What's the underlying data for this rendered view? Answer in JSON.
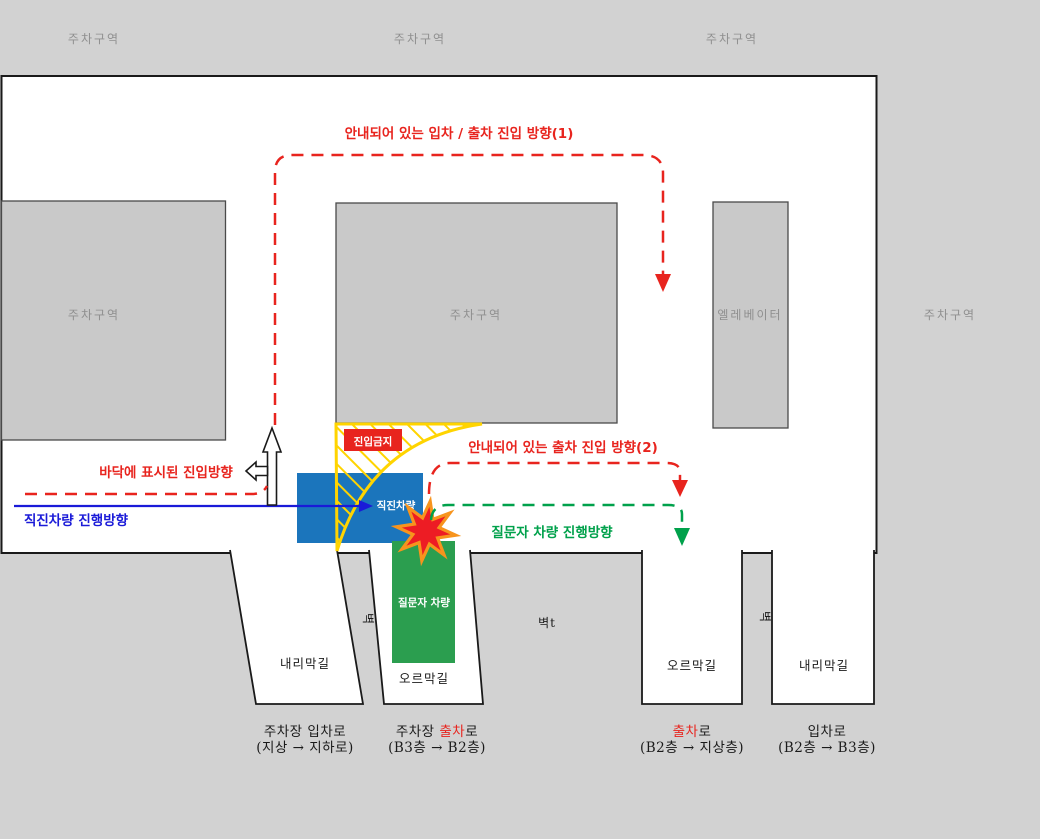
{
  "top_band": {
    "left": "주차구역",
    "middle": "주차구역",
    "right": "주차구역"
  },
  "zones": {
    "left_parking": "주차구역",
    "middle_parking": "주차구역",
    "elevator": "엘레베이터",
    "right_parking": "주차구역"
  },
  "labels": {
    "route1": "안내되어 있는 입차 / 출차 진입 방향(1)",
    "route2": "안내되어 있는 출차 진입 방향(2)",
    "questioner_route": "질문자 차량 진행방향",
    "floor_marked": "바닥에 표시된 진입방향",
    "straight_route": "직진차량 진행방향",
    "no_entry": "진입금지"
  },
  "vehicles": {
    "straight": "직진차량",
    "questioner": "질문자 차량"
  },
  "walls": {
    "left": "벽",
    "middle": "벽t",
    "right": "벽"
  },
  "ramps": {
    "bottom_left": "내리막길",
    "bottom_middle": "오르막길",
    "right_up": "오르막길",
    "right_down": "내리막길"
  },
  "exits": {
    "entry_b3": {
      "line1": "주차장 입차로",
      "line2": "(지상 → 지하로)"
    },
    "exit_b3": {
      "pre": "주차장 ",
      "red": "출차",
      "post": "로",
      "line2": "(B3층 → B2층)"
    },
    "exit_b2": {
      "red": "출차",
      "post": "로",
      "line2": "(B2층 → 지상층)"
    },
    "entry_b2": {
      "line1": "입차로",
      "line2": "(B2층 → B3층)"
    }
  },
  "colors": {
    "background": "#D2D2D2",
    "zone_fill": "#C9C9C9",
    "red": "#E8241E",
    "green": "#00A14B",
    "blue": "#1A1AD8",
    "vehicle_blue": "#1B75BC",
    "vehicle_green": "#2B9E4F",
    "yellow": "#FFD400",
    "star_fill": "#ED1C24",
    "star_stroke": "#F7941D"
  }
}
